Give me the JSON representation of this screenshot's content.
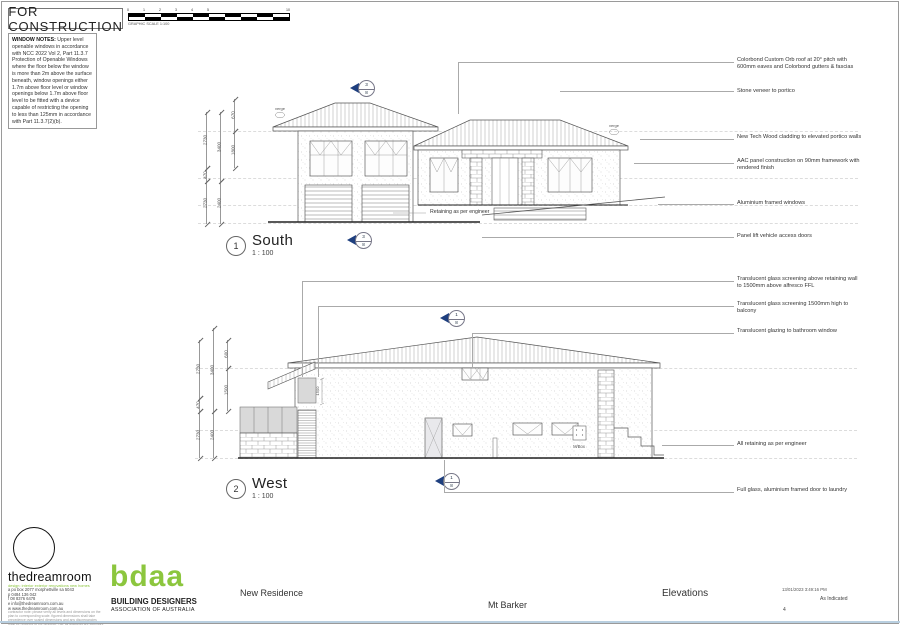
{
  "sheet": {
    "stamp": "FOR CONSTRUCTION",
    "scale_bar": {
      "label": "GRAPHIC SCALE 1:100",
      "ticks": [
        "0",
        "1",
        "2",
        "3",
        "4",
        "5",
        "10"
      ]
    }
  },
  "window_notes": {
    "title": "WINDOW NOTES:",
    "body": " Upper level openable windows in accordance with NCC 2022 Vol 2, Part 11.3.7 Protection of Openable Windows where the floor below the window is more than 2m above the surface beneath, window openings either 1.7m above floor level or window openings below 1.7m above floor level to be fitted with a device capable of restricting the opening to less than 125mm in accordance with Part 11.3.7(2)(b)."
  },
  "south": {
    "number": "1",
    "title": "South",
    "scale": "1 : 100",
    "verge_label": "verge",
    "retaining_note": "Retaining as per engineer",
    "marker_top": "3",
    "marker_bottom": "8",
    "dims_outer": [
      "2730",
      "470",
      "2730"
    ],
    "dims_mid": [
      "3400",
      "2400"
    ],
    "dims_inner": [
      "670",
      "1800"
    ]
  },
  "west": {
    "number": "2",
    "title": "West",
    "scale": "1 : 100",
    "marker_top": "1",
    "marker_bottom": "8",
    "mbox_label": "M/Box",
    "dim_screen": "1500",
    "dims_outer": [
      "2730",
      "470",
      "2730"
    ],
    "dims_mid": [
      "3400",
      "2400"
    ],
    "dims_inner": [
      "600",
      "1500"
    ]
  },
  "annotations_south": [
    "Colorbond Custom Orb roof at 20° pitch with 600mm eaves and Colorbond gutters & fascias",
    "Stone veneer to portico",
    "New Tech Wood cladding to elevated portico walls",
    "AAC panel construction on 90mm framework with rendered finish",
    "Aluminium framed windows",
    "Panel lift vehicle access doors"
  ],
  "annotations_west": [
    "Translucent glass screening above retaining wall to 1500mm above alfresco FFL",
    "Translucent glass screening 1500mm high to balcony",
    "Translucent glazing to bathroom window",
    "All retaining as per engineer",
    "Full glass, aluminium framed door to laundry"
  ],
  "titleblock": {
    "designer": {
      "name": "thedreamroom",
      "tagline": "design: interior exterior renovations new homes",
      "contacts": "a  po box 2077 morphettville sa 5043\np  0484 136 042\nf  08 8376 6478\ne  info@thedreamroom.com.au\nw  www.thedreamroom.com.au",
      "fine_print": "contractor note: please verify all levels and dimensions on the plan to corresponding scale. figured dimensions shall take precedence over scaled dimensions and any discrepancies shall be reported to the designer. NB. all drawings are copyright to the dream room pty ltd."
    },
    "bdaa": {
      "logo": "bdaa",
      "line1": "BUILDING DESIGNERS",
      "line2": "ASSOCIATION OF AUSTRALIA"
    },
    "project": "New Residence",
    "location": "Mt Barker",
    "sheet_title": "Elevations",
    "datetime": "13/01/2023 3:49:16 PM",
    "scale_note": "As Indicated",
    "sheet_number": "4"
  },
  "colors": {
    "marker_blue": "#1e3f7f",
    "bdaa_green": "#8cc63e"
  }
}
